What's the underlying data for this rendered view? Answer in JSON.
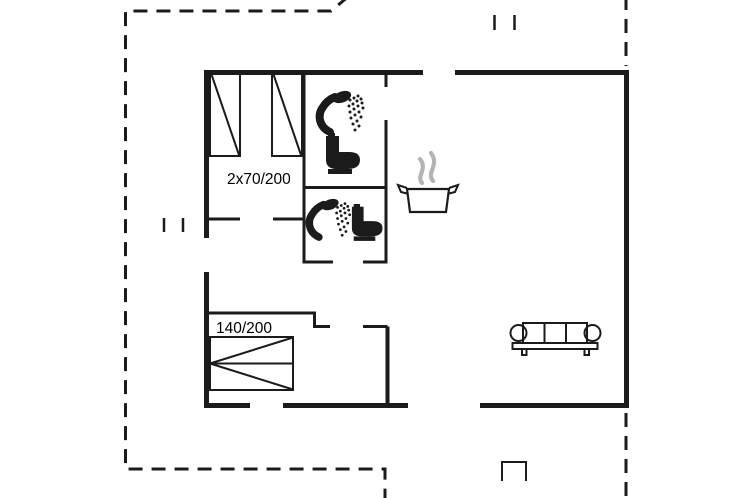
{
  "floor_plan": {
    "labels": {
      "single_beds": "2x70/200",
      "double_bed": "140/200"
    },
    "icons": [
      "single-bed-icon",
      "single-bed-icon",
      "shower-icon",
      "toilet-icon",
      "shower-icon",
      "toilet-icon",
      "cooking-pot-icon",
      "steam-icon",
      "double-bed-icon",
      "sofa-icon",
      "window-marks-icon",
      "window-marks-icon",
      "porch-step-icon"
    ],
    "colors": {
      "walls": "#1b1b1b",
      "steam": "#b4b4b4",
      "background": "#ffffff"
    }
  }
}
